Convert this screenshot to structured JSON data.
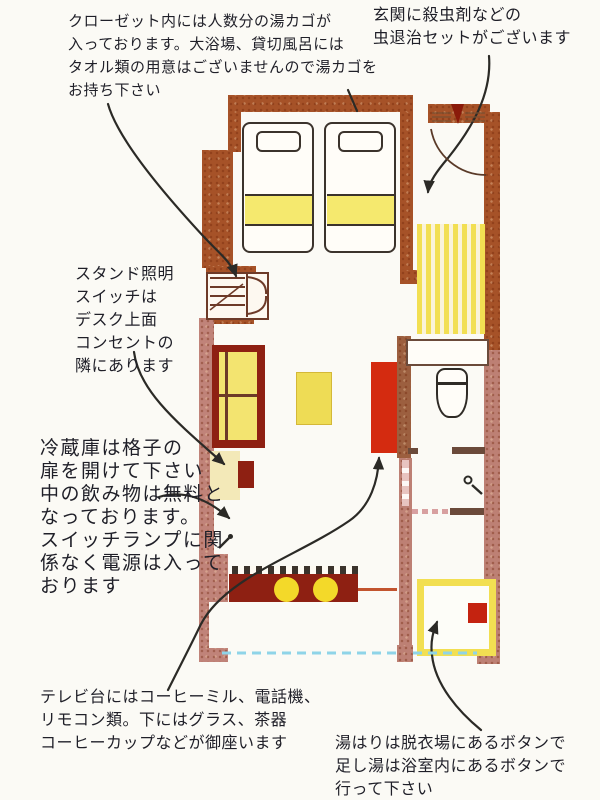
{
  "colors": {
    "paper": "#fbfaf5",
    "text": "#1f1f28",
    "ink": "#2b2a26",
    "wall-dark": "#a65228",
    "wall-pink": "#c08379",
    "wall-pink2": "#bd8074",
    "wall-brown": "#9c5f3f",
    "furn-red": "#8e2012",
    "bright-red": "#d42b10",
    "accent-yellow": "#f2df52",
    "pale-yellow": "#f3e9b8",
    "band-yellow": "#f5e96e",
    "sofa-yellow": "#f3e470",
    "table-yellow": "#eedc55",
    "stool-yellow": "#f3d929",
    "window-blue": "#8fd4e8"
  },
  "notes": {
    "closet": {
      "lines": [
        "クローゼット内には人数分の湯カゴが",
        "入っております。大浴場、貸切風呂には",
        "タオル類の用意はございませんので湯カゴを",
        "お持ち下さい"
      ]
    },
    "entrance": {
      "lines": [
        "玄関に殺虫剤などの",
        "虫退治セットがございます"
      ]
    },
    "lamp": {
      "lines": [
        "スタンド照明",
        "スイッチは",
        "デスク上面",
        "コンセントの",
        "隣にあります"
      ]
    },
    "fridge": {
      "lines": [
        "冷蔵庫は格子の",
        "扉を開けて下さい",
        "中の飲み物は無料と",
        "なっております。",
        "スイッチランプに関",
        "係なく電源は入って",
        "おります"
      ]
    },
    "tv": {
      "lines": [
        "テレビ台にはコーヒーミル、電話機、",
        "リモコン類。下にはグラス、茶器",
        "コーヒーカップなどが御座います"
      ]
    },
    "bath": {
      "lines": [
        "湯はりは脱衣場にあるボタンで",
        "足し湯は浴室内にあるボタンで",
        "行って下さい"
      ]
    }
  }
}
